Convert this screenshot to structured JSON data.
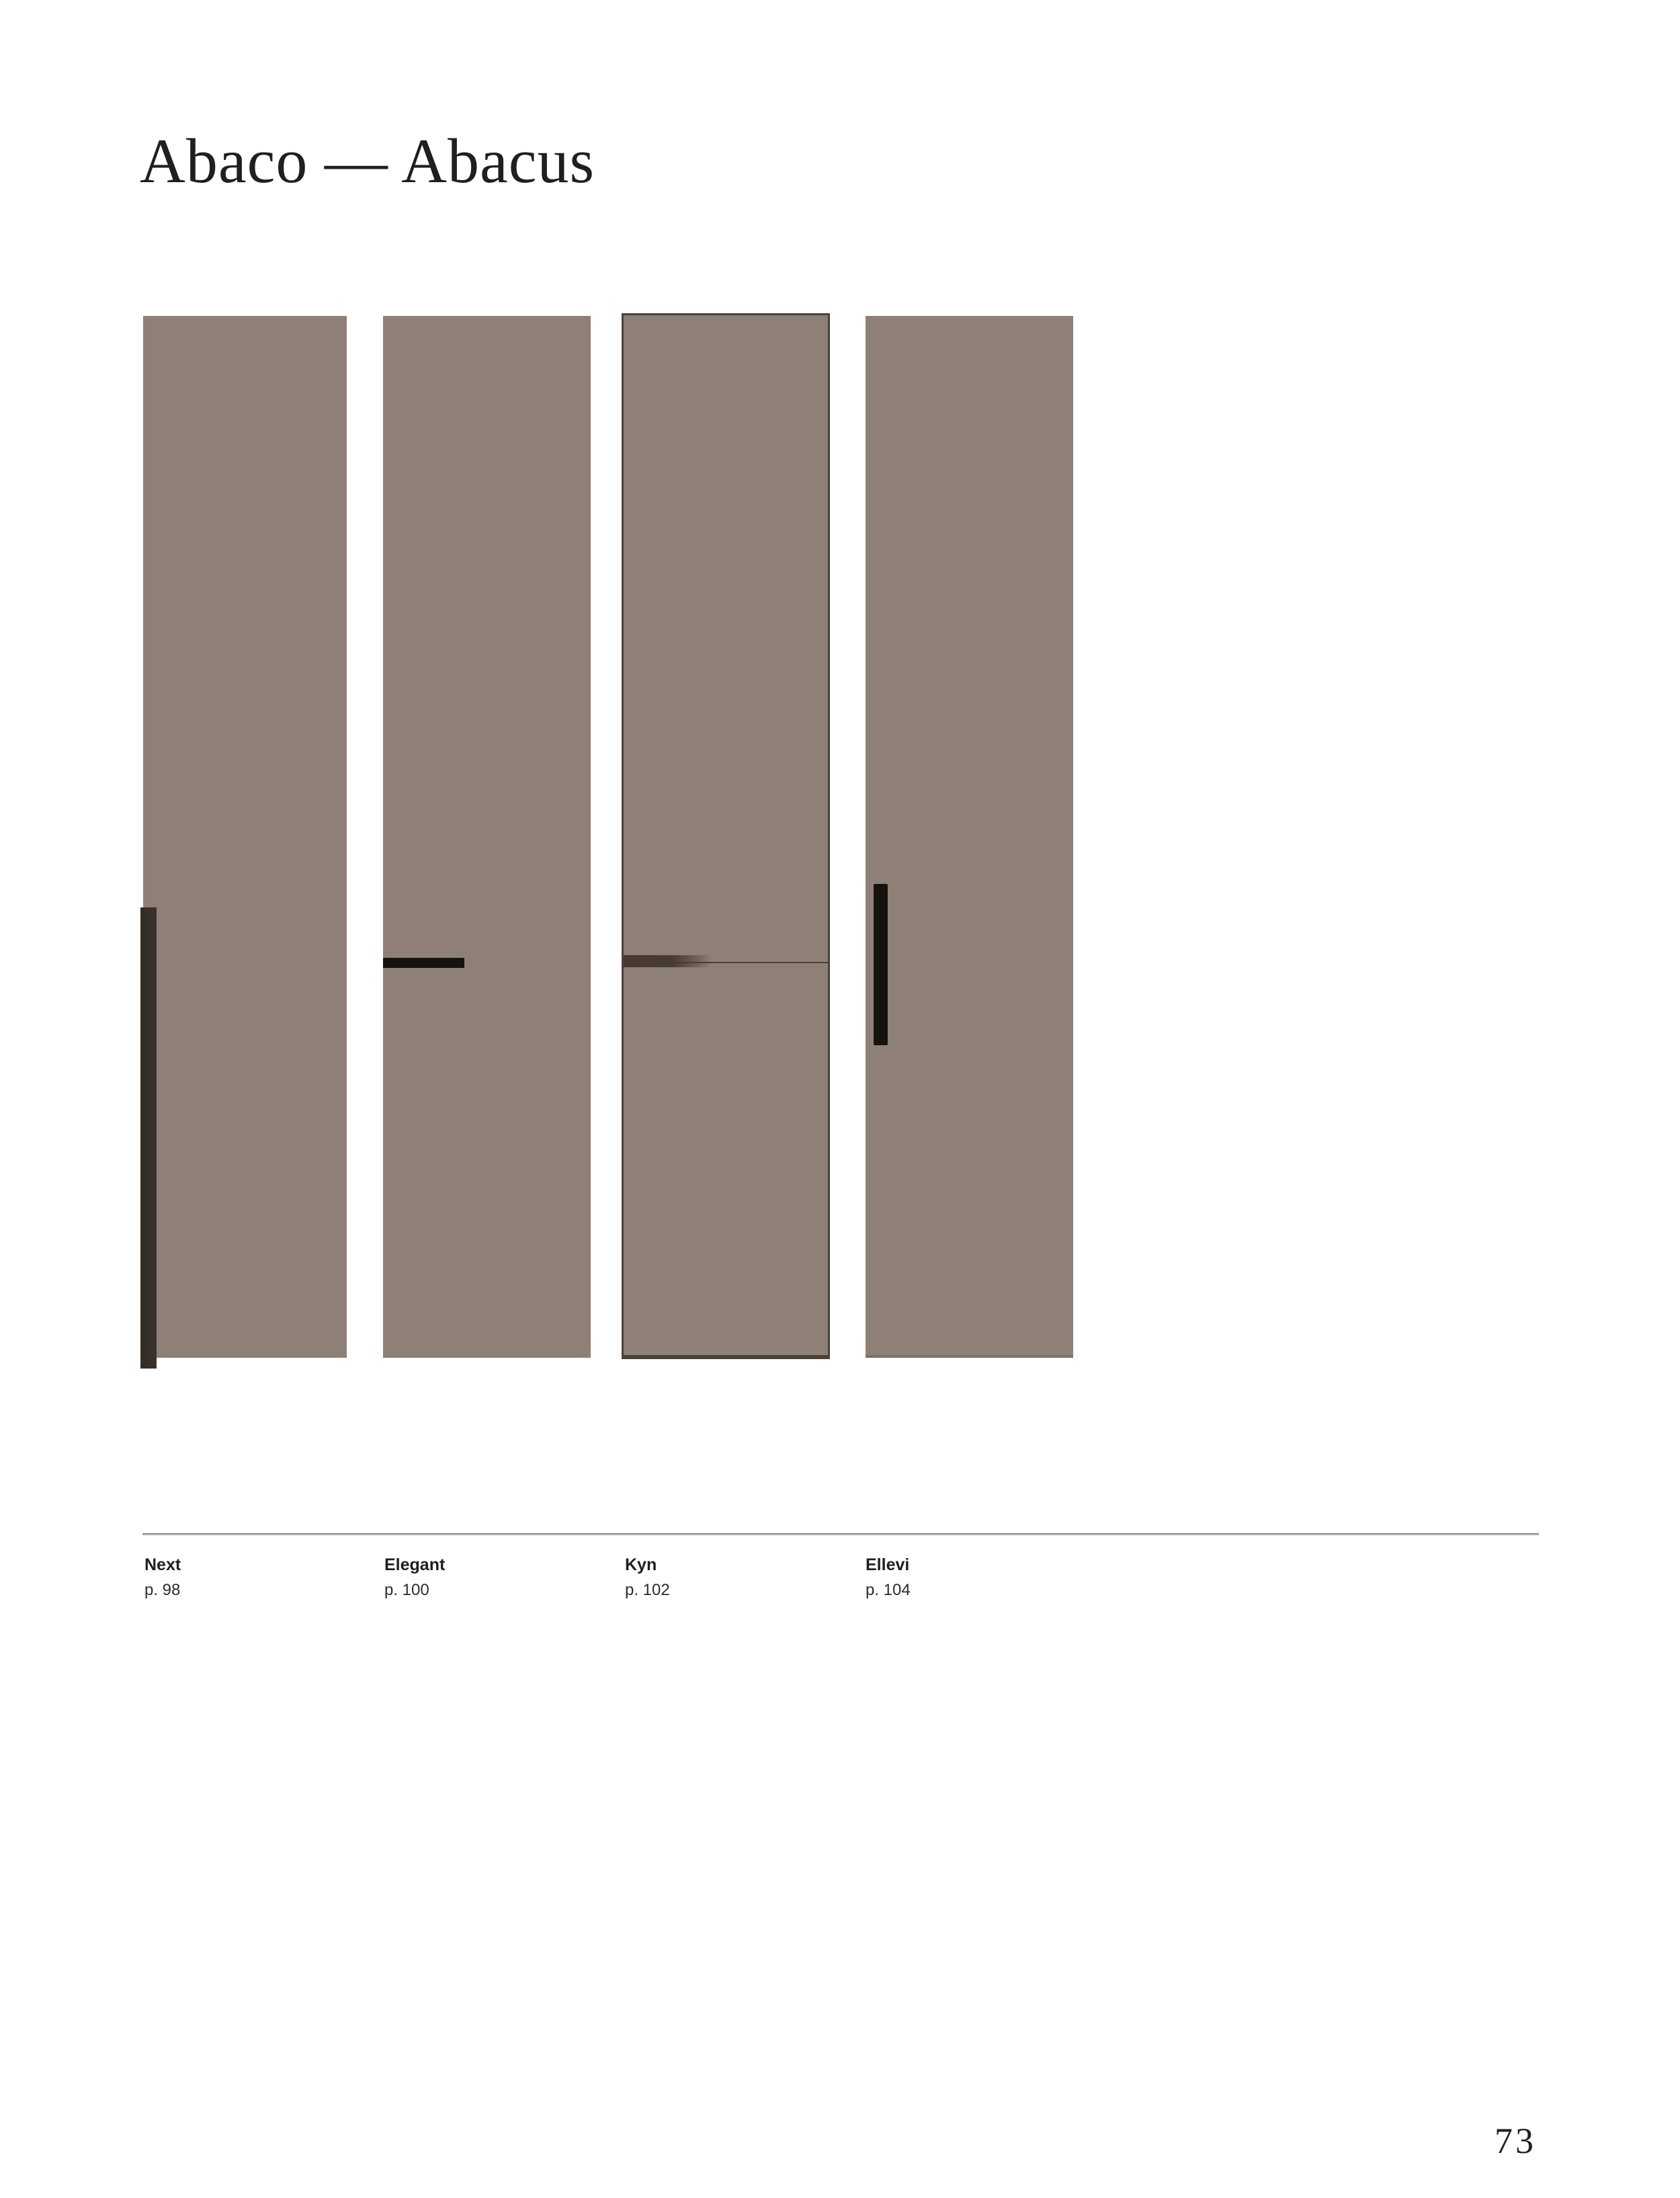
{
  "page": {
    "title": "Abaco — Abacus",
    "page_number": "73"
  },
  "colors": {
    "page_bg": "#ffffff",
    "panel_fill": "#8f8077",
    "panel_border_dark": "#4a4038",
    "handle_dark": "#3a322b",
    "handle_black": "#16130f",
    "divider": "#868686",
    "text_primary": "#1f1f1f"
  },
  "products": [
    {
      "name": "Next",
      "page_ref": "p. 98",
      "handle_style": "edge-strip-vertical"
    },
    {
      "name": "Elegant",
      "page_ref": "p. 100",
      "handle_style": "horizontal-bar"
    },
    {
      "name": "Kyn",
      "page_ref": "p. 102",
      "handle_style": "integrated-groove-seam"
    },
    {
      "name": "Ellevi",
      "page_ref": "p. 104",
      "handle_style": "inset-vertical-bar"
    }
  ]
}
